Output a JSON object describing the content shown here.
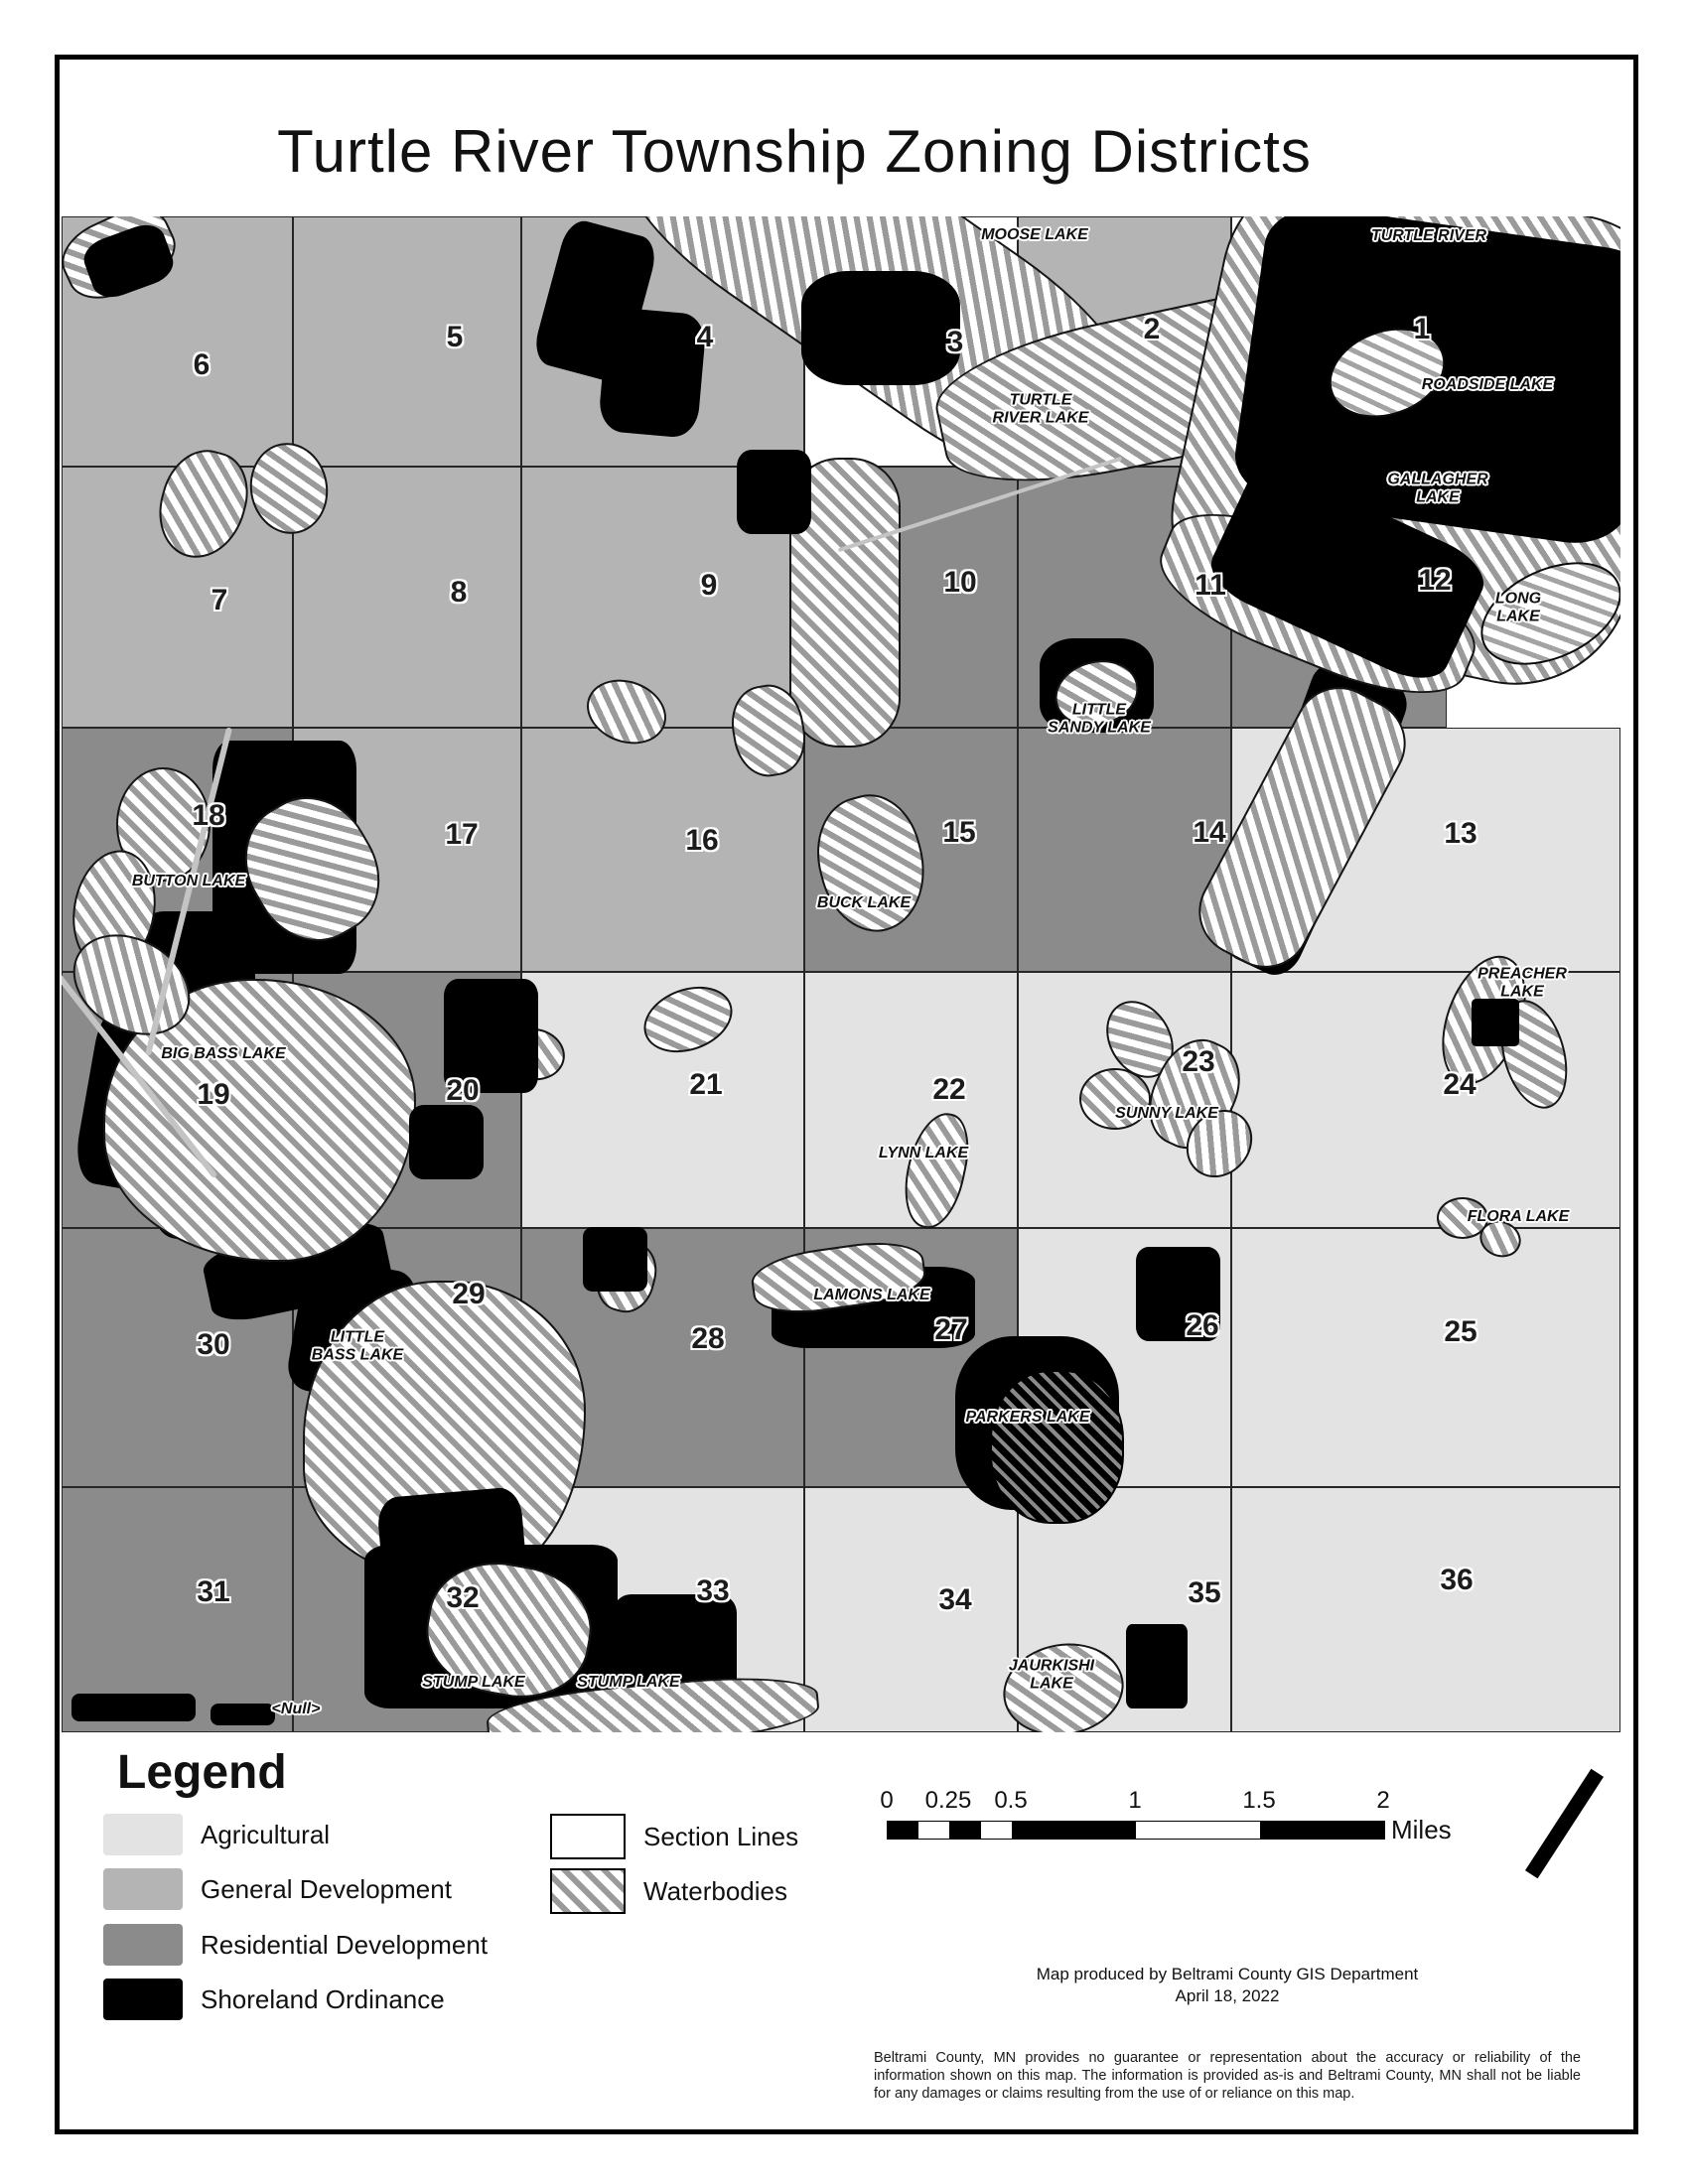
{
  "title": "Turtle River Township Zoning Districts",
  "map": {
    "sections": [
      {
        "num": "6",
        "zone": "gd"
      },
      {
        "num": "5",
        "zone": "gd"
      },
      {
        "num": "4",
        "zone": "gd"
      },
      {
        "num": "3",
        "zone": "none"
      },
      {
        "num": "2",
        "zone": "gd"
      },
      {
        "num": "1",
        "zone": "none"
      },
      {
        "num": "7",
        "zone": "gd"
      },
      {
        "num": "8",
        "zone": "gd"
      },
      {
        "num": "9",
        "zone": "gd"
      },
      {
        "num": "10",
        "zone": "rd"
      },
      {
        "num": "11",
        "zone": "rd"
      },
      {
        "num": "12",
        "zone": "rd"
      },
      {
        "num": "18",
        "zone": "rd"
      },
      {
        "num": "17",
        "zone": "gd"
      },
      {
        "num": "16",
        "zone": "gd"
      },
      {
        "num": "15",
        "zone": "rd"
      },
      {
        "num": "14",
        "zone": "rd"
      },
      {
        "num": "13",
        "zone": "ag"
      },
      {
        "num": "19",
        "zone": "rd"
      },
      {
        "num": "20",
        "zone": "rd"
      },
      {
        "num": "21",
        "zone": "ag"
      },
      {
        "num": "22",
        "zone": "ag"
      },
      {
        "num": "23",
        "zone": "ag"
      },
      {
        "num": "24",
        "zone": "ag"
      },
      {
        "num": "30",
        "zone": "rd"
      },
      {
        "num": "29",
        "zone": "rd"
      },
      {
        "num": "28",
        "zone": "rd"
      },
      {
        "num": "27",
        "zone": "rd"
      },
      {
        "num": "26",
        "zone": "ag"
      },
      {
        "num": "25",
        "zone": "ag"
      },
      {
        "num": "31",
        "zone": "rd"
      },
      {
        "num": "32",
        "zone": "rd"
      },
      {
        "num": "33",
        "zone": "ag"
      },
      {
        "num": "34",
        "zone": "ag"
      },
      {
        "num": "35",
        "zone": "ag"
      },
      {
        "num": "36",
        "zone": "ag"
      }
    ],
    "lakes": [
      "MOOSE LAKE",
      "TURTLE RIVER",
      "TURTLE\nRIVER LAKE",
      "ROADSIDE LAKE",
      "GALLAGHER\nLAKE",
      "LONG\nLAKE",
      "LITTLE\nSANDY LAKE",
      "BUTTON LAKE",
      "BUCK LAKE",
      "PREACHER\nLAKE",
      "BIG BASS LAKE",
      "SUNNY LAKE",
      "LYNN LAKE",
      "FLORA LAKE",
      "LAMONS LAKE",
      "LITTLE\nBASS LAKE",
      "PARKERS LAKE",
      "STUMP LAKE",
      "STUMP LAKE",
      "JAURKISHI\nLAKE",
      "<Null>"
    ]
  },
  "legend": {
    "title": "Legend",
    "items": [
      {
        "label": "Agricultural",
        "swatch": "agricultural"
      },
      {
        "label": "General Development",
        "swatch": "general-development"
      },
      {
        "label": "Residential Development",
        "swatch": "residential-development"
      },
      {
        "label": "Shoreland Ordinance",
        "swatch": "shoreland-ordinance"
      },
      {
        "label": "Section Lines",
        "swatch": "section-lines"
      },
      {
        "label": "Waterbodies",
        "swatch": "waterbodies"
      }
    ]
  },
  "scale_bar": {
    "tick_labels": [
      "0",
      "0.25",
      "0.5",
      "1",
      "1.5",
      "2"
    ],
    "unit": "Miles"
  },
  "attribution": {
    "line1": "Map produced by Beltrami County GIS Department",
    "line2": "April 18, 2022"
  },
  "disclaimer": "Beltrami County, MN provides no guarantee or representation about the accuracy or reliability of the information shown on this map.  The information is provided as-is and Beltrami County, MN shall not be liable for any damages or claims resulting from the use of or reliance on this map.",
  "colors": {
    "agricultural": "#e3e3e3",
    "general_development": "#b4b4b4",
    "residential_development": "#8b8b8b",
    "shoreland_ordinance": "#000000",
    "waterbody_stripe": "#9a9a9a",
    "section_line": "#262626"
  }
}
